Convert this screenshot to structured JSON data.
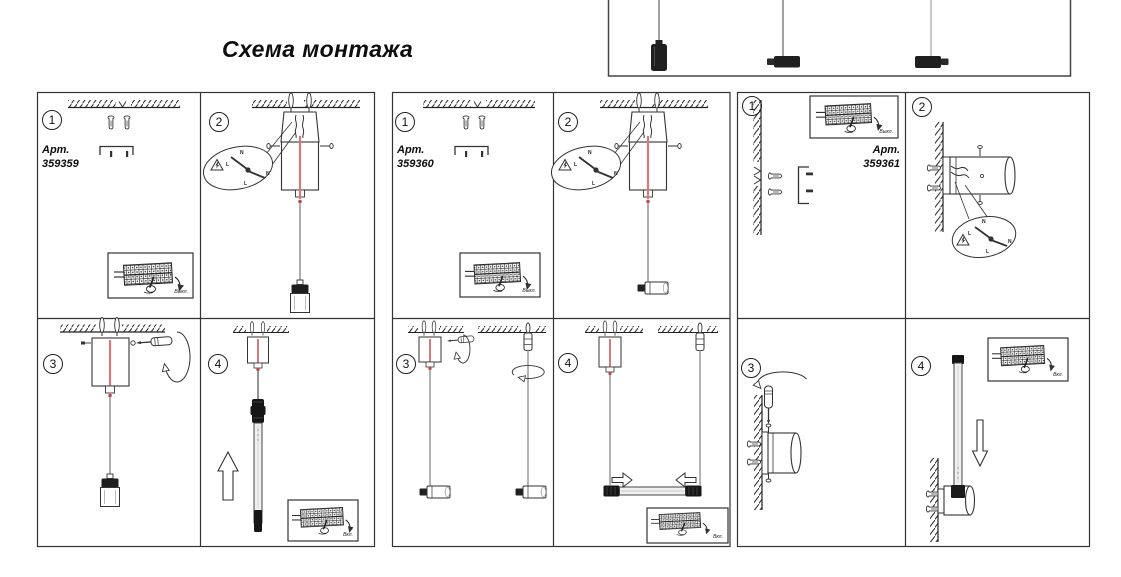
{
  "page": {
    "title": "Схема монтажа"
  },
  "panels": [
    {
      "art_label": "Арт.",
      "art_number": "359359",
      "steps": [
        "1",
        "2",
        "3",
        "4"
      ]
    },
    {
      "art_label": "Арт.",
      "art_number": "359360",
      "steps": [
        "1",
        "2",
        "3",
        "4"
      ]
    },
    {
      "art_label": "Арт.",
      "art_number": "359361",
      "steps": [
        "1",
        "2",
        "3",
        "4"
      ]
    }
  ],
  "labels": {
    "power_off": "Выкл.",
    "power_on": "Вкл.",
    "wire_neutral": "N",
    "wire_live": "L"
  },
  "colors": {
    "line": "#333333",
    "cable_red": "#d97878",
    "cable_bead_red": "#c04848",
    "lamp_black": "#1f1f1f"
  }
}
